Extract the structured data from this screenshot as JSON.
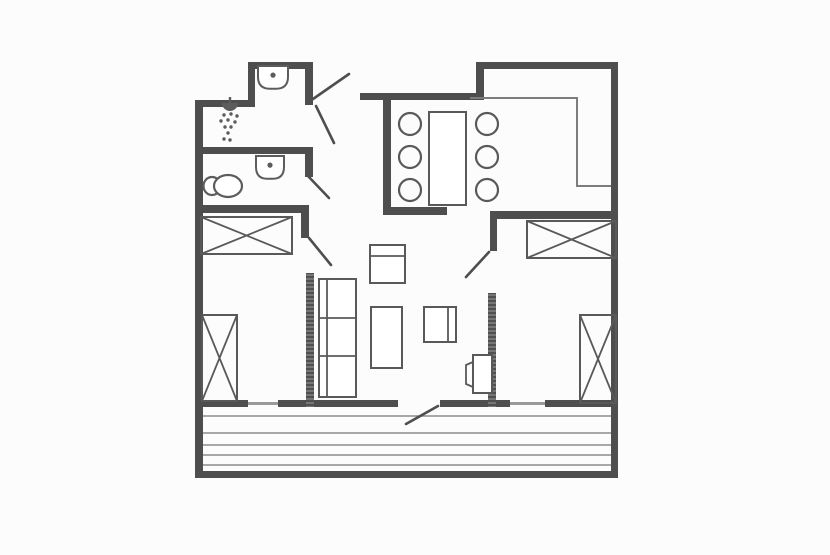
{
  "page": {
    "width": 830,
    "height": 555,
    "background": "#fcfcfc"
  },
  "colors": {
    "wall": "#4e4e4e",
    "hatch_bg": "#767676",
    "hatch_line": "#3f3f3f",
    "furniture": "#595959",
    "fixture": "#5c5c5c",
    "thin": "#7d7d7d",
    "window": "#9a9a9a",
    "plank": "#8c8c8c",
    "door": "#4e4e4e"
  },
  "plan": {
    "walls": [
      {
        "name": "outer-left-wall",
        "x": 195,
        "y": 100,
        "w": 8,
        "h": 378
      },
      {
        "name": "upper-left-top-wall",
        "x": 195,
        "y": 100,
        "w": 60,
        "h": 7
      },
      {
        "name": "entry-alcove-left-wall",
        "x": 248,
        "y": 62,
        "w": 7,
        "h": 45
      },
      {
        "name": "entry-alcove-top-wall",
        "x": 248,
        "y": 62,
        "w": 64,
        "h": 7
      },
      {
        "name": "entry-alcove-right-wall",
        "x": 305,
        "y": 62,
        "w": 8,
        "h": 43
      },
      {
        "name": "top-middle-wall",
        "x": 360,
        "y": 93,
        "w": 123,
        "h": 7
      },
      {
        "name": "kitchen-step-wall",
        "x": 476,
        "y": 62,
        "w": 8,
        "h": 38
      },
      {
        "name": "top-right-wall",
        "x": 476,
        "y": 62,
        "w": 142,
        "h": 7
      },
      {
        "name": "outer-right-wall",
        "x": 611,
        "y": 62,
        "w": 7,
        "h": 416
      },
      {
        "name": "bottom-wall-segment-1",
        "x": 195,
        "y": 400,
        "w": 53,
        "h": 7
      },
      {
        "name": "bottom-wall-segment-2",
        "x": 278,
        "y": 400,
        "w": 120,
        "h": 7
      },
      {
        "name": "bottom-wall-segment-3",
        "x": 440,
        "y": 400,
        "w": 70,
        "h": 7
      },
      {
        "name": "bottom-wall-segment-4",
        "x": 545,
        "y": 400,
        "w": 73,
        "h": 7
      },
      {
        "name": "deck-front-wall",
        "x": 195,
        "y": 471,
        "w": 423,
        "h": 7
      },
      {
        "name": "shower-bathroom-divider-wall",
        "x": 195,
        "y": 147,
        "w": 117,
        "h": 7
      },
      {
        "name": "bathroom-right-wall",
        "x": 305,
        "y": 147,
        "w": 8,
        "h": 30
      },
      {
        "name": "bathroom-bedroom-divider-wall",
        "x": 195,
        "y": 205,
        "w": 113,
        "h": 8
      },
      {
        "name": "left-bedroom-right-wall-upper",
        "x": 301,
        "y": 205,
        "w": 8,
        "h": 33
      },
      {
        "name": "dining-left-wall",
        "x": 383,
        "y": 100,
        "w": 8,
        "h": 107
      },
      {
        "name": "dining-bottom-wall",
        "x": 383,
        "y": 207,
        "w": 64,
        "h": 8
      },
      {
        "name": "right-bedroom-top-wall",
        "x": 490,
        "y": 211,
        "w": 128,
        "h": 8
      },
      {
        "name": "right-bedroom-left-wall-upper",
        "x": 490,
        "y": 211,
        "w": 7,
        "h": 40
      }
    ],
    "hatched_walls": [
      {
        "name": "left-bedroom-right-wall-lower",
        "x": 306,
        "y": 273,
        "w": 8,
        "h": 134
      },
      {
        "name": "right-bedroom-left-wall-lower",
        "x": 488,
        "y": 293,
        "w": 8,
        "h": 114
      }
    ],
    "windows": [
      {
        "name": "left-bedroom-window",
        "x": 248,
        "y": 402,
        "w": 30,
        "h": 3
      },
      {
        "name": "right-bedroom-window",
        "x": 510,
        "y": 402,
        "w": 35,
        "h": 3
      }
    ],
    "doors": [
      {
        "name": "entrance-door",
        "x1": 313,
        "y1": 99,
        "x2": 349,
        "y2": 74
      },
      {
        "name": "shower-room-door",
        "x1": 316,
        "y1": 106,
        "x2": 334,
        "y2": 143
      },
      {
        "name": "bathroom-door",
        "x1": 307,
        "y1": 175,
        "x2": 329,
        "y2": 198
      },
      {
        "name": "left-bedroom-door",
        "x1": 309,
        "y1": 238,
        "x2": 331,
        "y2": 265
      },
      {
        "name": "right-bedroom-door",
        "x1": 489,
        "y1": 252,
        "x2": 466,
        "y2": 277
      },
      {
        "name": "terrace-door",
        "x1": 438,
        "y1": 406,
        "x2": 406,
        "y2": 424
      }
    ],
    "kitchen_counter": {
      "name": "kitchen-counter-outline",
      "points": [
        [
          470,
          98
        ],
        [
          577,
          98
        ],
        [
          577,
          186
        ],
        [
          611,
          186
        ]
      ]
    },
    "crossed_boxes": [
      {
        "name": "left-bedroom-wardrobe",
        "x": 201,
        "y": 217,
        "w": 91,
        "h": 37
      },
      {
        "name": "left-bedroom-bed",
        "x": 202,
        "y": 315,
        "w": 35,
        "h": 86
      },
      {
        "name": "right-bedroom-wardrobe",
        "x": 527,
        "y": 221,
        "w": 89,
        "h": 37
      },
      {
        "name": "right-bedroom-bed",
        "x": 580,
        "y": 315,
        "w": 36,
        "h": 88
      }
    ],
    "furniture_rects": [
      {
        "name": "dining-table",
        "x": 429,
        "y": 112,
        "w": 37,
        "h": 93
      },
      {
        "name": "sofa",
        "x": 319,
        "y": 279,
        "w": 37,
        "h": 118
      },
      {
        "name": "armchair",
        "x": 370,
        "y": 245,
        "w": 35,
        "h": 38
      },
      {
        "name": "coffee-table",
        "x": 371,
        "y": 307,
        "w": 31,
        "h": 61
      },
      {
        "name": "tv-chair",
        "x": 424,
        "y": 307,
        "w": 32,
        "h": 35
      },
      {
        "name": "side-unit",
        "x": 473,
        "y": 355,
        "w": 19,
        "h": 38
      }
    ],
    "furniture_lines": [
      {
        "name": "sofa-back-line",
        "x1": 327,
        "y1": 280,
        "x2": 327,
        "y2": 396
      },
      {
        "name": "sofa-divider-line-1",
        "x1": 320,
        "y1": 318,
        "x2": 355,
        "y2": 318
      },
      {
        "name": "sofa-divider-line-2",
        "x1": 320,
        "y1": 356,
        "x2": 355,
        "y2": 356
      },
      {
        "name": "armchair-back-line",
        "x1": 371,
        "y1": 256,
        "x2": 404,
        "y2": 256
      },
      {
        "name": "tv-chair-back-line",
        "x1": 448,
        "y1": 308,
        "x2": 448,
        "y2": 341
      }
    ],
    "furniture_polylines": [
      {
        "name": "side-unit-front",
        "points": [
          [
            473,
            362
          ],
          [
            466,
            365
          ],
          [
            466,
            384
          ],
          [
            473,
            387
          ]
        ]
      }
    ],
    "dining_chairs": {
      "name": "dining-chair",
      "r": 11,
      "centers": [
        [
          410,
          124
        ],
        [
          410,
          157
        ],
        [
          410,
          190
        ],
        [
          487,
          124
        ],
        [
          487,
          157
        ],
        [
          487,
          190
        ]
      ]
    },
    "toilet": {
      "name": "toilet",
      "bowl": {
        "cx": 228,
        "cy": 186,
        "rx": 14,
        "ry": 11
      },
      "tank": {
        "cx": 212,
        "cy": 186,
        "rx": 8.5,
        "ry": 9
      }
    },
    "sinks": [
      {
        "name": "hall-washbasin",
        "x": 258,
        "y": 66,
        "w": 30,
        "h": 24
      },
      {
        "name": "bathroom-washbasin",
        "x": 256,
        "y": 156,
        "w": 28,
        "h": 24
      }
    ],
    "shower": {
      "name": "shower-head",
      "head": {
        "x": 222,
        "y": 103,
        "w": 16
      },
      "stem": {
        "x1": 230,
        "y1": 97,
        "x2": 230,
        "y2": 103
      },
      "dot_r": 1.7,
      "dots": [
        [
          224,
          115
        ],
        [
          231,
          114
        ],
        [
          237,
          116
        ],
        [
          221,
          121
        ],
        [
          228,
          120
        ],
        [
          235,
          122
        ],
        [
          225,
          127
        ],
        [
          231,
          127
        ],
        [
          228,
          133
        ],
        [
          224,
          139
        ],
        [
          230,
          140
        ]
      ]
    },
    "deck": {
      "name": "deck-plank",
      "x1": 203,
      "x2": 611,
      "plank_ys": [
        416,
        433,
        445,
        455,
        465
      ]
    }
  }
}
